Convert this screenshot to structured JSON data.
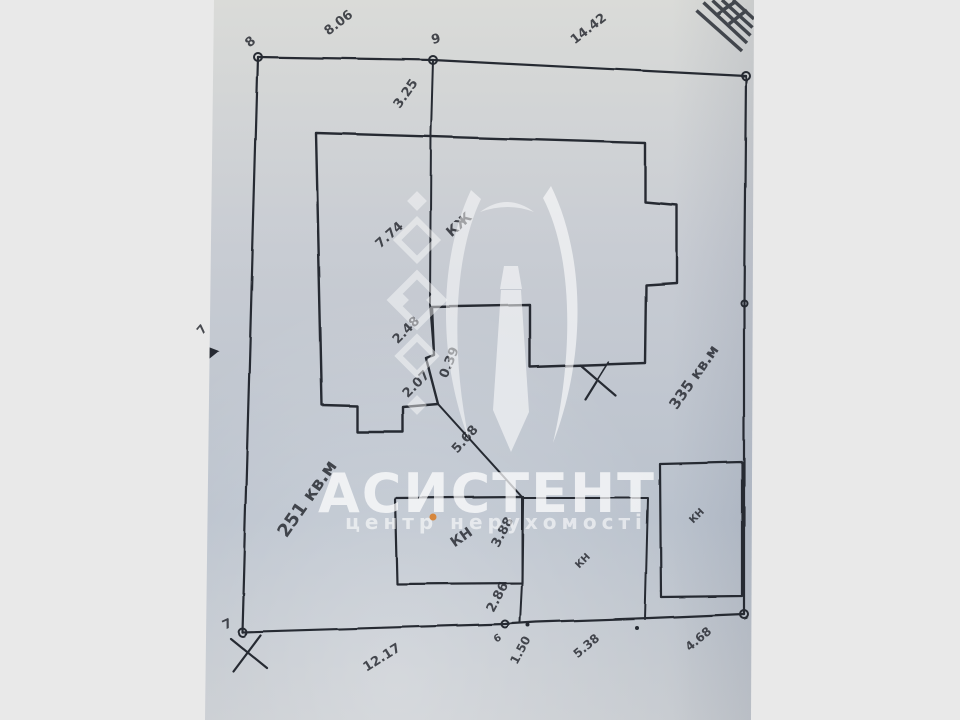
{
  "watermark": {
    "title": "АСИСТЕНТ",
    "subtitle": "центр нерухомості",
    "dot_color": "#d6863c"
  },
  "plan": {
    "ink_color": "#262b33",
    "paper_tint": "#c6ccd3",
    "margin_color": "#e9e9e9",
    "areas": {
      "left_plot": "251 кв.м",
      "right_plot": "335 кв.м"
    },
    "buildings": {
      "main_house": "КЖ",
      "shed_left": "КН",
      "shed_mid": "КН",
      "shed_right": "КН"
    },
    "points": {
      "p6": "6",
      "p7": "7",
      "p8": "8",
      "p9": "9"
    },
    "dims": {
      "top_left": "8.06",
      "top_right": "14.42",
      "fence_upper": "3.25",
      "house_side": "7.74",
      "jog_a": "2.48",
      "jog_b": "0.39",
      "jog_c": "2.07",
      "diagonal": "5.68",
      "shed_side": "3.88",
      "shed_to_border": "2.86",
      "bottom_long": "12.17",
      "bottom_a": "1.50",
      "bottom_b": "5.38",
      "bottom_c": "4.68",
      "left_edge_partial": "7"
    }
  }
}
